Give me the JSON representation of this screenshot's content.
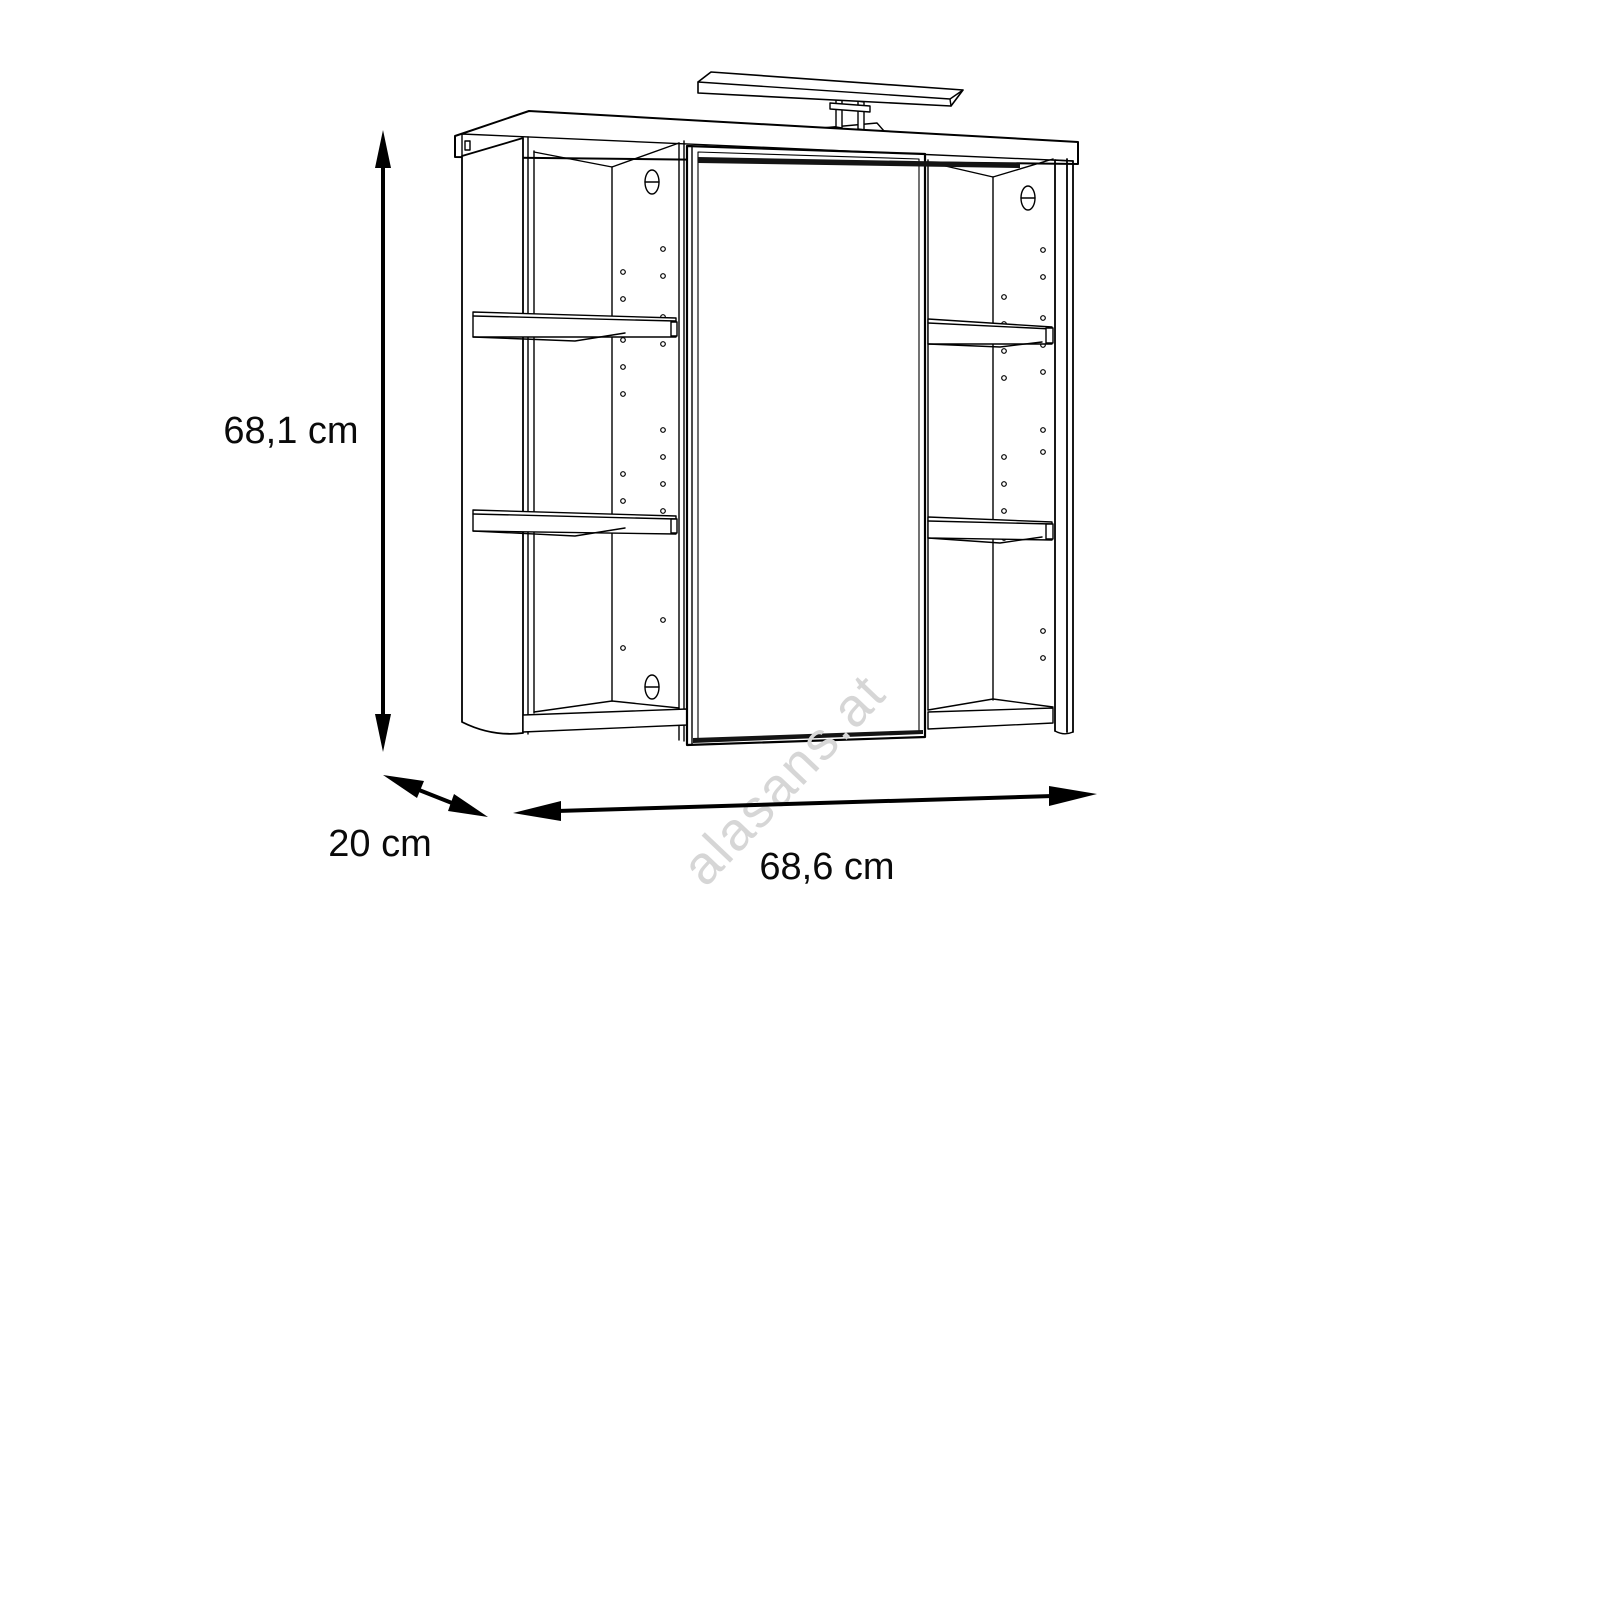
{
  "background_color": "#ffffff",
  "drawing": {
    "line_color": "#000000"
  },
  "dimensions": {
    "height": {
      "label": "68,1 cm"
    },
    "depth": {
      "label": "20 cm"
    },
    "width": {
      "label": "68,6 cm"
    }
  },
  "watermark": {
    "text": "alasans.at",
    "color": "#d6d6d6"
  }
}
